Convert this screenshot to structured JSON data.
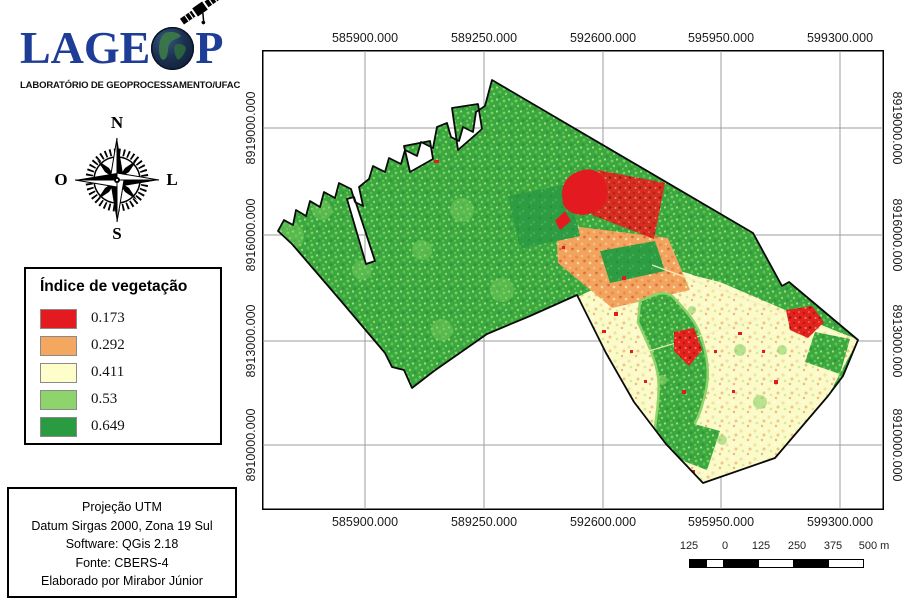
{
  "logo": {
    "title": "LAGEOP",
    "text_left": "LAGE",
    "text_right": "P",
    "subtitle": "LABORATÓRIO DE GEOPROCESSAMENTO/UFAC",
    "brand_color": "#1e3d96"
  },
  "compass": {
    "north": "N",
    "east": "L",
    "south": "S",
    "west": "O"
  },
  "legend": {
    "title": "Índice de vegetação",
    "items": [
      {
        "label": "0.173",
        "color": "#e31a1f"
      },
      {
        "label": "0.292",
        "color": "#f4a75f"
      },
      {
        "label": "0.411",
        "color": "#fdfec9"
      },
      {
        "label": "0.53",
        "color": "#8ed36b"
      },
      {
        "label": "0.649",
        "color": "#2b9b41"
      }
    ]
  },
  "info_box": {
    "lines": [
      "Projeção UTM",
      "Datum Sirgas 2000, Zona 19 Sul",
      "Software: QGis 2.18",
      "Fonte: CBERS-4",
      "Elaborado por Mirabor Júnior"
    ]
  },
  "map_frame": {
    "x_ticks": [
      "585900.000",
      "589250.000",
      "592600.000",
      "595950.000",
      "599300.000"
    ],
    "y_ticks": [
      "8919000.000",
      "8916000.000",
      "8913000.000",
      "8910000.000"
    ],
    "grid_color": "#9e9e9e"
  },
  "scale_bar": {
    "labels": [
      "125",
      "0",
      "125",
      "250",
      "375",
      "500 m"
    ]
  }
}
